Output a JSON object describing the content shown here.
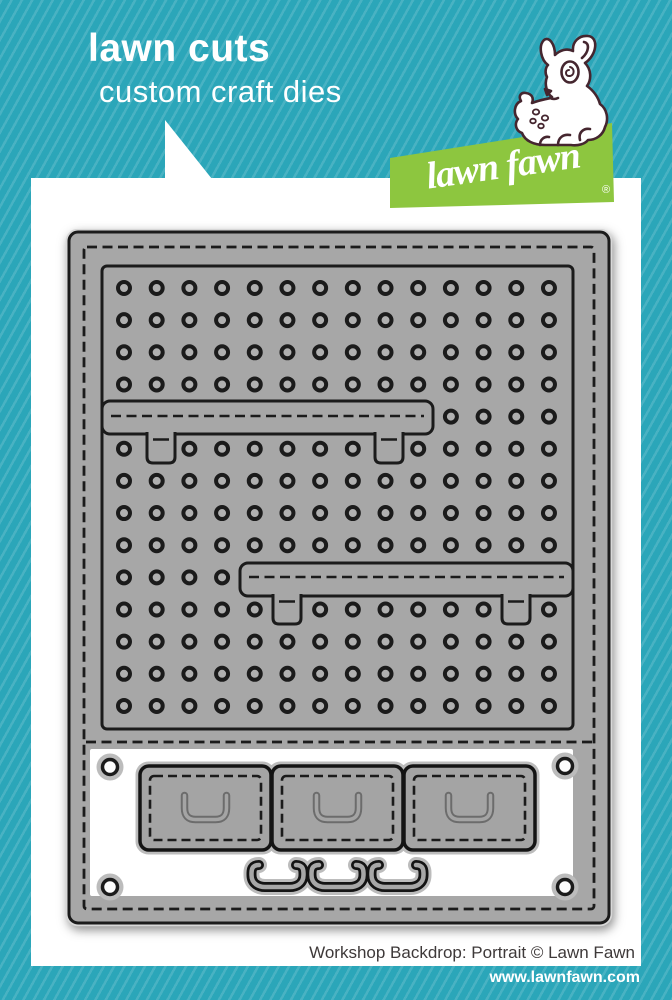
{
  "header": {
    "title": "lawn cuts",
    "subtitle": "custom craft dies"
  },
  "logo": {
    "brand": "lawn fawn",
    "registered": "®",
    "green": "#8DC63F",
    "fawn_icon": "fawn-icon"
  },
  "footer": {
    "product": "Workshop Backdrop: Portrait © Lawn Fawn",
    "website": "www.lawnfawn.com"
  },
  "colors": {
    "teal_background": "#2BA6B9",
    "stripe": "rgba(255,255,255,0.14)",
    "card_white": "#FFFFFF",
    "plate_gray": "#A7A7A7",
    "outline_dark": "#1B1B1B",
    "halo_gray": "#BCBCBC",
    "hole_fill": "#B0B0B0",
    "bevel": "#D8D8D8",
    "handle_gray": "#6C6C6C",
    "caption_text": "#3E3939",
    "fawn_outline": "#45262F"
  },
  "die": {
    "plate": {
      "w": 540,
      "h": 691,
      "rx": 9,
      "stroke_w": 3
    },
    "stitch": {
      "x": 15,
      "y": 15,
      "w": 510,
      "h": 662,
      "dash": "10 5.5",
      "stroke_w": 2.8
    },
    "pegboard": {
      "x": 33,
      "y": 34,
      "w": 471,
      "h": 463,
      "rx": 5,
      "stroke_w": 3
    },
    "grid": {
      "cols": 14,
      "rows": 14,
      "x0": 55,
      "y0": 56,
      "dx": 32.69,
      "dy": 32.15,
      "r": 6,
      "ring_w": 4
    },
    "skips": [
      {
        "row": 4,
        "from": 0,
        "to": 9
      },
      {
        "row": 9,
        "from": 4,
        "to": 13
      },
      {
        "row": 5,
        "cols": [
          1,
          8
        ]
      },
      {
        "row": 10,
        "cols": [
          5,
          12
        ]
      }
    ],
    "shelves": [
      {
        "x": 33,
        "y": 169,
        "w": 331,
        "h": 33,
        "dash_y": 15,
        "bracket_h": 29,
        "brackets": [
          78,
          306
        ]
      },
      {
        "x": 171,
        "y": 331,
        "w": 333,
        "h": 33,
        "dash_y": 14,
        "bracket_h": 28,
        "brackets": [
          204,
          433
        ]
      }
    ],
    "bracket_w": 28,
    "separator": {
      "y": 510,
      "x1": 17,
      "x2": 523,
      "dash": "10 5.5",
      "stroke_w": 2.8
    },
    "tray": {
      "x": 21,
      "y": 517,
      "w": 483,
      "h": 147
    },
    "corner_circles": [
      [
        41,
        535
      ],
      [
        496,
        534
      ],
      [
        41,
        655
      ],
      [
        496,
        655
      ]
    ],
    "circle": {
      "halo_r": 13.5,
      "ring_r": 7.5,
      "ring_w": 3.5
    },
    "drawers": {
      "xs": [
        71,
        203,
        335
      ],
      "y": 534,
      "w": 131,
      "h": 84,
      "rx": 9,
      "inset": 10,
      "inner_dash": "9 5",
      "handle_w": 42,
      "handle_h": 23
    },
    "hooks": {
      "xs": [
        179,
        239,
        299
      ],
      "y": 627,
      "w": 59,
      "h": 32
    }
  }
}
